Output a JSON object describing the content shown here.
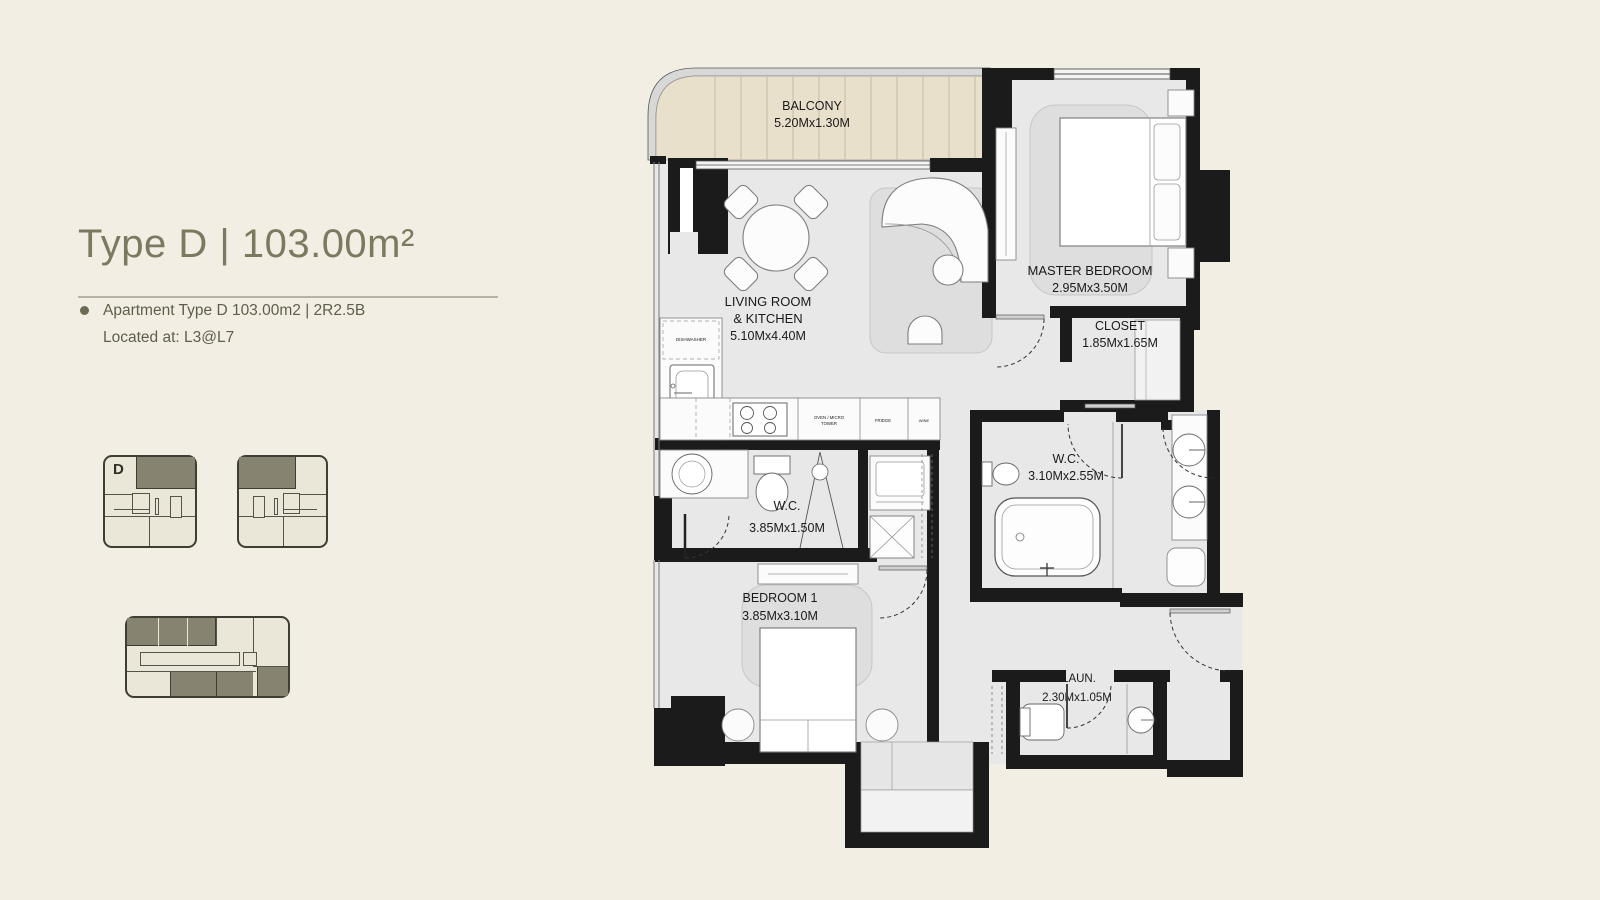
{
  "colors": {
    "page_bg": "#f3eee3",
    "title_accent": "#7b7a60",
    "body_text": "#5f5e4b",
    "keyplan_highlight": "#868371",
    "keyplan_bg": "#eae7d9",
    "wall": "#1b1b1b",
    "floor": "#e8e8e8",
    "balcony_floor": "#e9e0cc",
    "rug": "#dedede"
  },
  "panel": {
    "title": "Type D | 103.00m²",
    "details": [
      "Apartment Type D 103.00m2 | 2R2.5B",
      "Located at: L3@L7"
    ]
  },
  "keyplans": {
    "unit_label": "D"
  },
  "plan": {
    "rooms": {
      "balcony": {
        "name": "BALCONY",
        "dims": "5.20Mx1.30M"
      },
      "living": {
        "line1": "LIVING ROOM",
        "line2": "& KITCHEN",
        "dims": "5.10Mx4.40M"
      },
      "master": {
        "name": "MASTER BEDROOM",
        "dims": "2.95Mx3.50M"
      },
      "closet": {
        "name": "CLOSET",
        "dims": "1.85Mx1.65M"
      },
      "wc_master": {
        "name": "W.C.",
        "dims": "3.10Mx2.55M"
      },
      "wc_guest": {
        "name": "W.C.",
        "dims": "3.85Mx1.50M"
      },
      "bedroom1": {
        "name": "BEDROOM 1",
        "dims": "3.85Mx3.10M"
      },
      "laundry": {
        "name": "LAUN.",
        "dims": "2.30Mx1.05M"
      }
    },
    "appliances": {
      "dishwasher": "DISHWASHER",
      "oven1": "OVEN / MICRO",
      "oven2": "TOWER",
      "fridge": "FRIDGE",
      "wine": "WINE"
    }
  }
}
